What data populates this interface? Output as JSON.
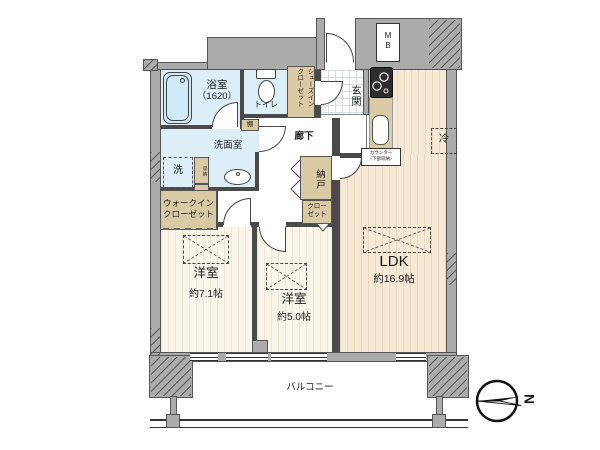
{
  "floorplan": {
    "labels": {
      "bathroom": "浴室",
      "bathroom_size": "（1620）",
      "toilet": "トイレ",
      "shoes_closet": "シューズイン\nクローゼット",
      "entrance": "玄関",
      "meter_box": "M\nB",
      "hallway": "廊下",
      "shelf": "棚",
      "washroom": "洗面室",
      "washer": "洗",
      "storage": "収納",
      "walk_in_closet": "ウォークイン\nクローゼット",
      "storeroom": "納戸",
      "closet": "クロー\nゼット",
      "bedroom1": "洋室",
      "bedroom1_size": "約7.1帖",
      "bedroom2": "洋室",
      "bedroom2_size": "約5.0帖",
      "ldk": "LDK",
      "ldk_size": "約16.9帖",
      "refrigerator": "冷",
      "counter": "カウンター\n（下部収納）",
      "balcony": "バルコニー",
      "compass_north": "N"
    },
    "colors": {
      "wall_gray": "#ababab",
      "wet_area_blue": "#dceef6",
      "closet_tan": "#d9caa4",
      "ldk_floor": "#f6e9d5",
      "bedroom_floor": "#f8f4e9",
      "outline": "#444444"
    }
  }
}
